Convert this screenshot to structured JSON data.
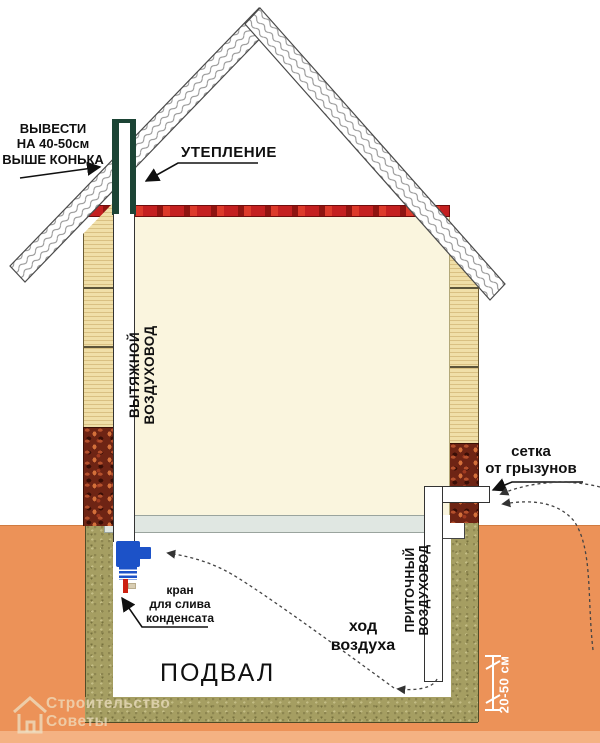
{
  "diagram_title": "Схема вентиляции подвала частного дома",
  "labels": {
    "vent_out": {
      "line1": "ВЫВЕСТИ",
      "line2": "НА 40-50см",
      "line3": "ВЫШЕ КОНЬКА"
    },
    "insulation": "УТЕПЛЕНИЕ",
    "exhaust_duct": "ВЫТЯЖНОЙ ВОЗДУХОВОД",
    "supply_duct": "ПРИТОЧНЫЙ ВОЗДУХОВОД",
    "rodent_mesh": {
      "line1": "сетка",
      "line2": "от грызунов"
    },
    "condensate_valve": {
      "line1": "кран",
      "line2": "для слива",
      "line3": "конденсата"
    },
    "air_path": {
      "line1": "ход",
      "line2": "воздуха"
    },
    "basement": "ПОДВАЛ",
    "dimension": "20-50 см"
  },
  "watermark": {
    "line1": "Строительство",
    "line2": "Советы"
  },
  "colors": {
    "soil": "#EC9258",
    "soil_edge": "#F4B283",
    "basement_wall": "#A59E62",
    "wall": "#F0DFA8",
    "plinth": "#6E2414",
    "insulation_band": "#C42020",
    "room_fill": "#FAF5DE",
    "slab": "#E0E7E2",
    "pipe_green": "#1C4435",
    "valve_blue": "#1C52C8",
    "drain_red": "#CC2010",
    "text": "#101010",
    "dimension_text": "#FFFFFF"
  }
}
